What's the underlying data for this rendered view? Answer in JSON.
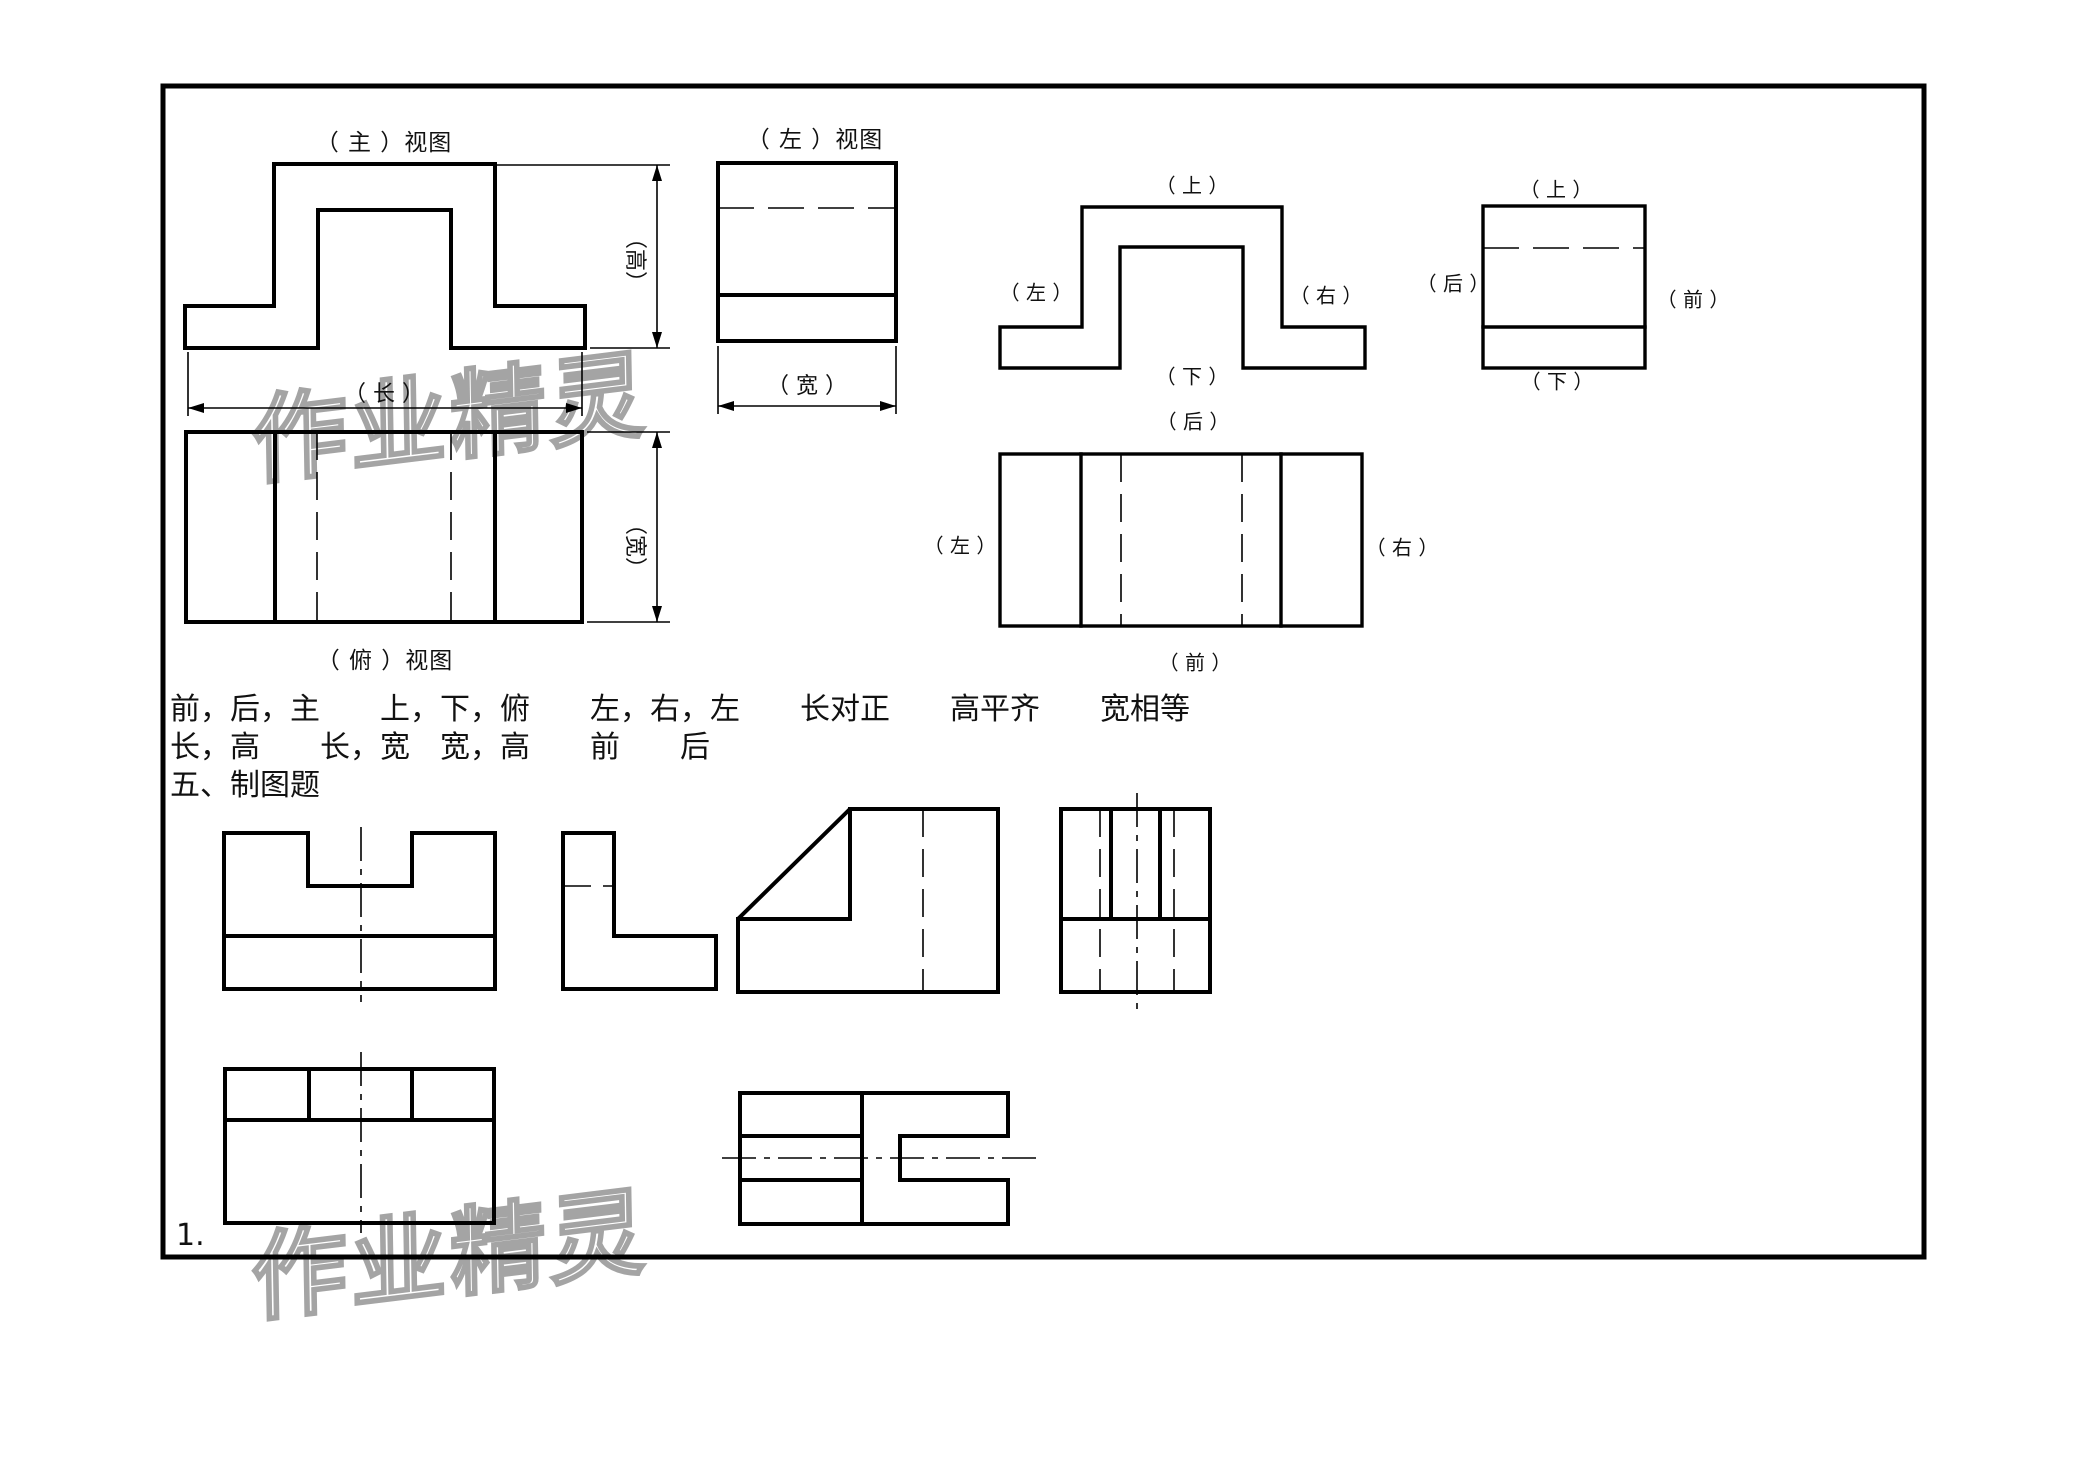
{
  "colors": {
    "background": "#ffffff",
    "line": "#000000",
    "text": "#111111",
    "watermark": "#9b9b9b"
  },
  "watermark": {
    "text": "作业精灵"
  },
  "views": {
    "front": {
      "title": "（ 主 ）视图",
      "length_label": "（ 长 ）",
      "height_label": "（高）"
    },
    "left": {
      "title": "（ 左 ）视图",
      "width_label": "（ 宽 ）"
    },
    "top": {
      "title": "（ 俯 ）视图",
      "width_label": "（宽）"
    },
    "front_dirs": {
      "top": "（ 上 ）",
      "left": "（ 左 ）",
      "right": "（ 右 ）",
      "bottom": "（ 下 ）"
    },
    "top_dirs": {
      "top": "（ 后 ）",
      "left": "（ 左 ）",
      "right": "（ 右 ）",
      "bottom": "（ 前 ）"
    },
    "side_dirs": {
      "top": "（ 上 ）",
      "left": "（ 后 ）",
      "right": "（ 前 ）",
      "bottom": "（ 下 ）"
    }
  },
  "answers": {
    "line1": "前，后，主　　上，下，俯　　左，右，左　　长对正　　高平齐　　宽相等",
    "line2": "长，高　　长，宽　宽，高　　前　　后",
    "line3": "五、制图题"
  },
  "item_number": "1."
}
